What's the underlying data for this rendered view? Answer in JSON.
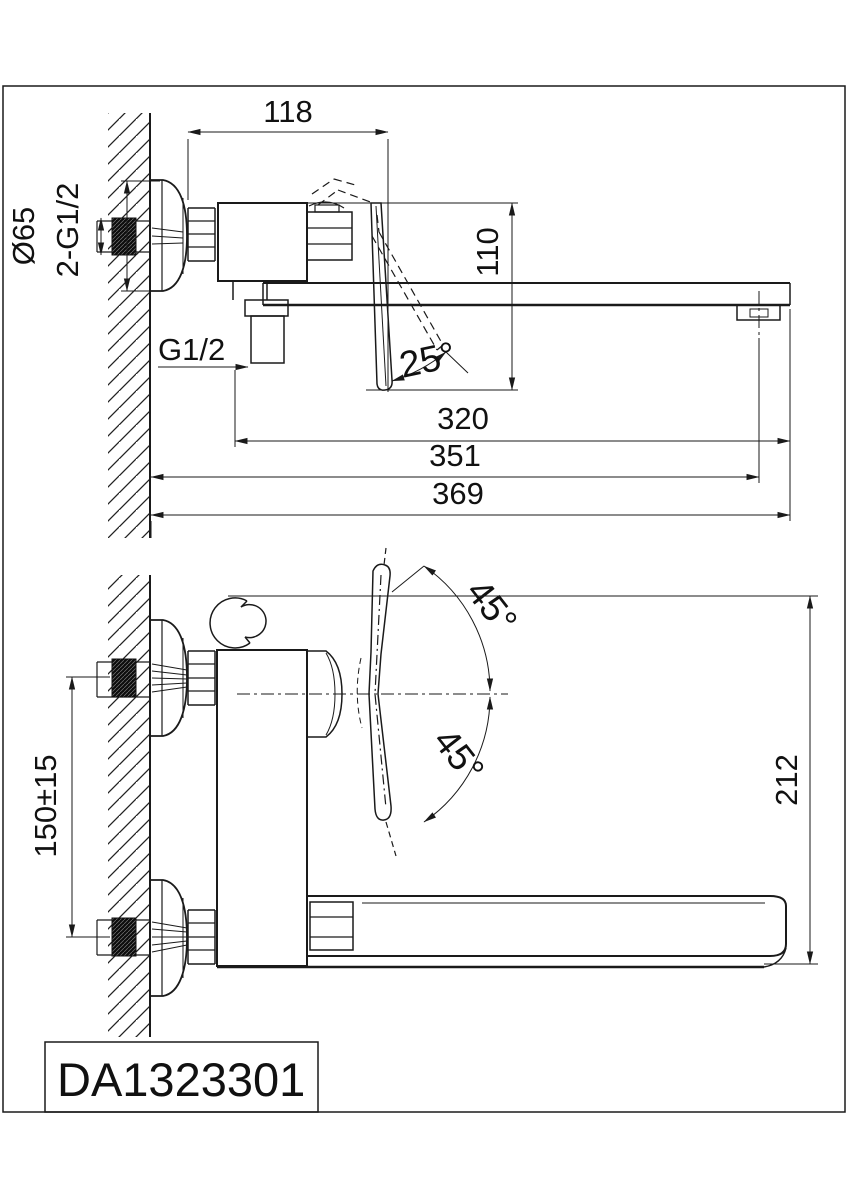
{
  "drawing": {
    "model_number": "DA1323301",
    "side_view": {
      "dim_body_depth": "118",
      "dim_height_drop": "110",
      "dim_escutcheon_diameter": "Ø65",
      "dim_supply_connections": "2-G1/2",
      "dim_shower_outlet": "G1/2",
      "dim_handle_angle": "25°",
      "dim_reach_320": "320",
      "dim_reach_351": "351",
      "dim_reach_369": "369"
    },
    "front_view": {
      "dim_handle_up_angle": "45°",
      "dim_handle_down_angle": "45°",
      "dim_supply_spacing": "150±15",
      "dim_overall_height": "212"
    },
    "colors": {
      "line": "#1a1a1a",
      "background": "#ffffff"
    }
  }
}
